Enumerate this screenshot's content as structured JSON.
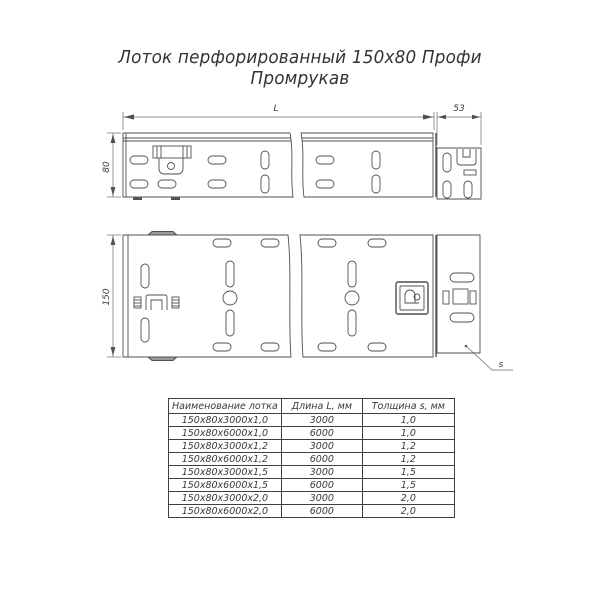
{
  "title": {
    "line1": "Лоток перфорированный 150х80 Профи",
    "line2": "Промрукав"
  },
  "drawing": {
    "length_label": "L",
    "connector_length_label": "53",
    "height_label": "80",
    "width_label": "150",
    "thickness_pointer_label": "s"
  },
  "colors": {
    "line": "#4f4f4f",
    "text": "#333333",
    "background": "#ffffff"
  },
  "table": {
    "headers": [
      "Наименование лотка",
      "Длина L, мм",
      "Толщина s, мм"
    ],
    "rows": [
      {
        "name": "150х80х3000х1,0",
        "length": "3000",
        "thickness": "1,0"
      },
      {
        "name": "150х80х6000х1,0",
        "length": "6000",
        "thickness": "1,0"
      },
      {
        "name": "150х80х3000х1,2",
        "length": "3000",
        "thickness": "1,2"
      },
      {
        "name": "150х80х6000х1,2",
        "length": "6000",
        "thickness": "1,2"
      },
      {
        "name": "150х80х3000х1,5",
        "length": "3000",
        "thickness": "1,5"
      },
      {
        "name": "150х80х6000х1,5",
        "length": "6000",
        "thickness": "1,5"
      },
      {
        "name": "150х80х3000х2,0",
        "length": "3000",
        "thickness": "2,0"
      },
      {
        "name": "150х80х6000х2,0",
        "length": "6000",
        "thickness": "2,0"
      }
    ]
  }
}
